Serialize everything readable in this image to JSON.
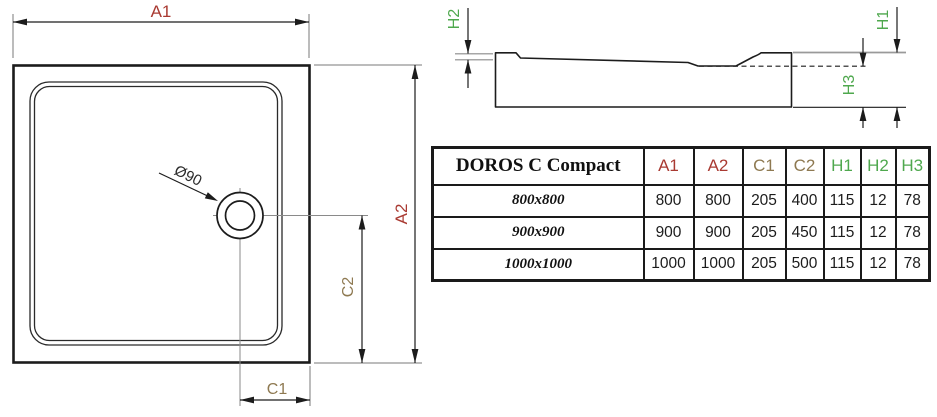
{
  "colors": {
    "dim_a": "#a93a32",
    "dim_c": "#8e7951",
    "dim_h": "#4fa84e"
  },
  "top_view": {
    "labels": {
      "a1": "A1",
      "a2": "A2",
      "c1": "C1",
      "c2": "C2",
      "drain_diameter": "Ø90"
    }
  },
  "side_view": {
    "labels": {
      "h1": "H1",
      "h2": "H2",
      "h3": "H3"
    }
  },
  "table": {
    "title": "DOROS C Compact",
    "columns": [
      {
        "label": "A1"
      },
      {
        "label": "A2"
      },
      {
        "label": "C1"
      },
      {
        "label": "C2"
      },
      {
        "label": "H1"
      },
      {
        "label": "H2"
      },
      {
        "label": "H3"
      }
    ],
    "rows": [
      {
        "size": "800x800",
        "values": [
          "800",
          "800",
          "205",
          "400",
          "115",
          "12",
          "78"
        ]
      },
      {
        "size": "900x900",
        "values": [
          "900",
          "900",
          "205",
          "450",
          "115",
          "12",
          "78"
        ]
      },
      {
        "size": "1000x1000",
        "values": [
          "1000",
          "1000",
          "205",
          "500",
          "115",
          "12",
          "78"
        ]
      }
    ]
  }
}
